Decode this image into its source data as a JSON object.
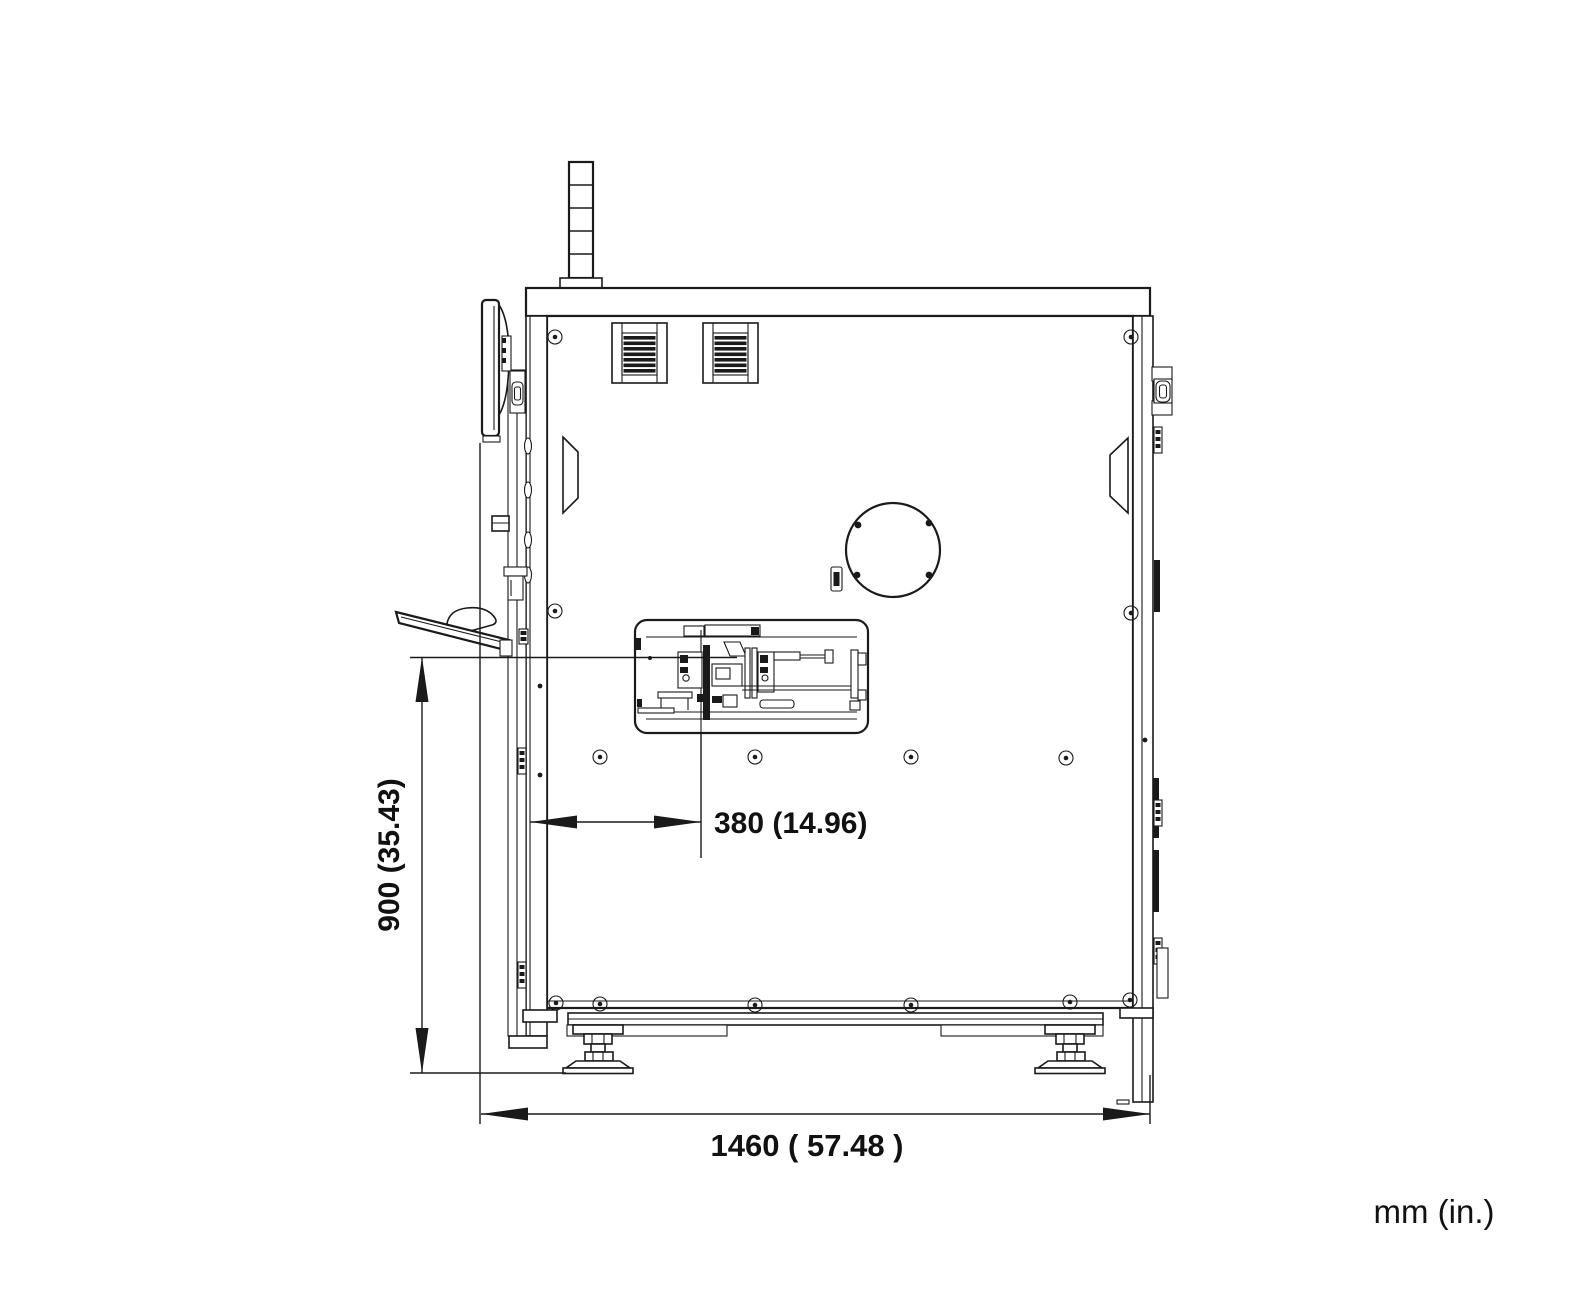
{
  "page": {
    "background": "#ffffff"
  },
  "drawing": {
    "type": "engineering-side-view",
    "line_color": "#1a1a1a",
    "text_color": "#111111",
    "units_note": "mm (in.)"
  },
  "labels": {
    "height_dimension": "900 (35.43)",
    "tool_offset_dimension": "380 (14.96)",
    "overall_width_dimension": "1460 ( 57.48 )",
    "units": "mm (in.)"
  },
  "dimensions": {
    "work_surface_height": {
      "mm": 900,
      "inches": 35.43
    },
    "front_to_tool_center": {
      "mm": 380,
      "inches": 14.96
    },
    "overall_width": {
      "mm": 1460,
      "inches": 57.48
    }
  },
  "parts": [
    "signal-tower",
    "top-cover",
    "cabinet-body",
    "ventilation-grille",
    "door-handle-recess",
    "fan-cutout",
    "process-window-mechanism",
    "monitor",
    "monitor-mount",
    "keyboard-tray",
    "mouse",
    "door-hinge",
    "latch-handle",
    "base-frame",
    "leveling-foot",
    "panel-screw"
  ]
}
